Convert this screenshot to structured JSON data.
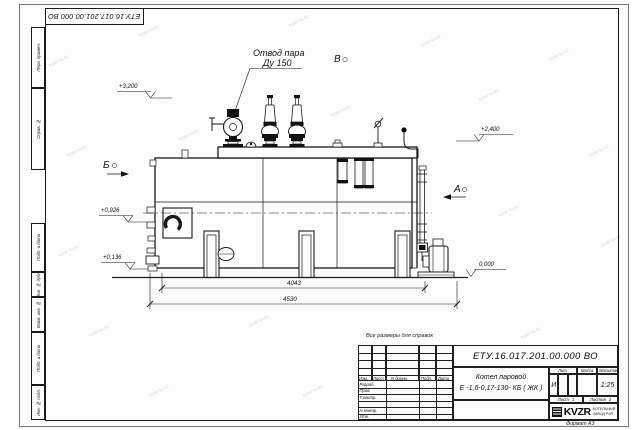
{
  "sheet": {
    "top_stamp": "ЕТУ.16.017.201.00.000  ВО",
    "reference_note": "Все размеры для справок",
    "format_note": "Формат А3",
    "margin_fields": [
      "Перв. примен.",
      "Справ. №",
      "Подп. и дата",
      "Инв. № дубл.",
      "Взам. инв. №",
      "Подп. и дата",
      "Инв. № подл."
    ]
  },
  "watermark": {
    "text": "kotel-kv.kz",
    "positions": [
      [
        48,
        58
      ],
      [
        138,
        28
      ],
      [
        288,
        18
      ],
      [
        420,
        38
      ],
      [
        548,
        52
      ],
      [
        66,
        148
      ],
      [
        178,
        132
      ],
      [
        330,
        108
      ],
      [
        478,
        92
      ],
      [
        588,
        148
      ],
      [
        58,
        248
      ],
      [
        168,
        238
      ],
      [
        348,
        228
      ],
      [
        498,
        208
      ],
      [
        600,
        238
      ],
      [
        88,
        328
      ],
      [
        248,
        318
      ],
      [
        302,
        388
      ],
      [
        148,
        388
      ],
      [
        520,
        330
      ]
    ]
  },
  "callouts": {
    "steam_outlet_line1": "Отвод пара",
    "steam_outlet_line2": "Ду 150"
  },
  "views": {
    "a": "А",
    "b": "Б",
    "v": "В"
  },
  "elevations": {
    "e3200": "+3,200",
    "e2400": "+2,400",
    "e0926": "+0,926",
    "e0136": "+0,136",
    "e0000": "0,000"
  },
  "dimensions": {
    "d4043": "4043",
    "d4530": "4530"
  },
  "title_block": {
    "designation": "ЕТУ.16.017.201.00.000  ВО",
    "product_name_line1": "Котел паровой",
    "product_name_line2": "Е -1,6-0,17-130- КБ ( ЖК )",
    "header_cols": [
      "Изм.",
      "Лист",
      "N докум.",
      "Подп.",
      "Дата"
    ],
    "row_labels": [
      "Разраб.",
      "Пров.",
      "Т.контр.",
      "Н.контр.",
      "Утв."
    ],
    "lit_label": "Лит.",
    "mass_label": "Масса",
    "scale_label": "Масштаб",
    "lit_value": "И",
    "scale_value": "1:25",
    "sheet_label": "Лист",
    "sheet_value": "1",
    "sheets_label": "Листов",
    "sheets_value": "2",
    "logo_text": "KVZR",
    "logo_caption_line1": "КОТЕЛЬНЫЙ",
    "logo_caption_line2": "ЗАВОД РЭП"
  }
}
